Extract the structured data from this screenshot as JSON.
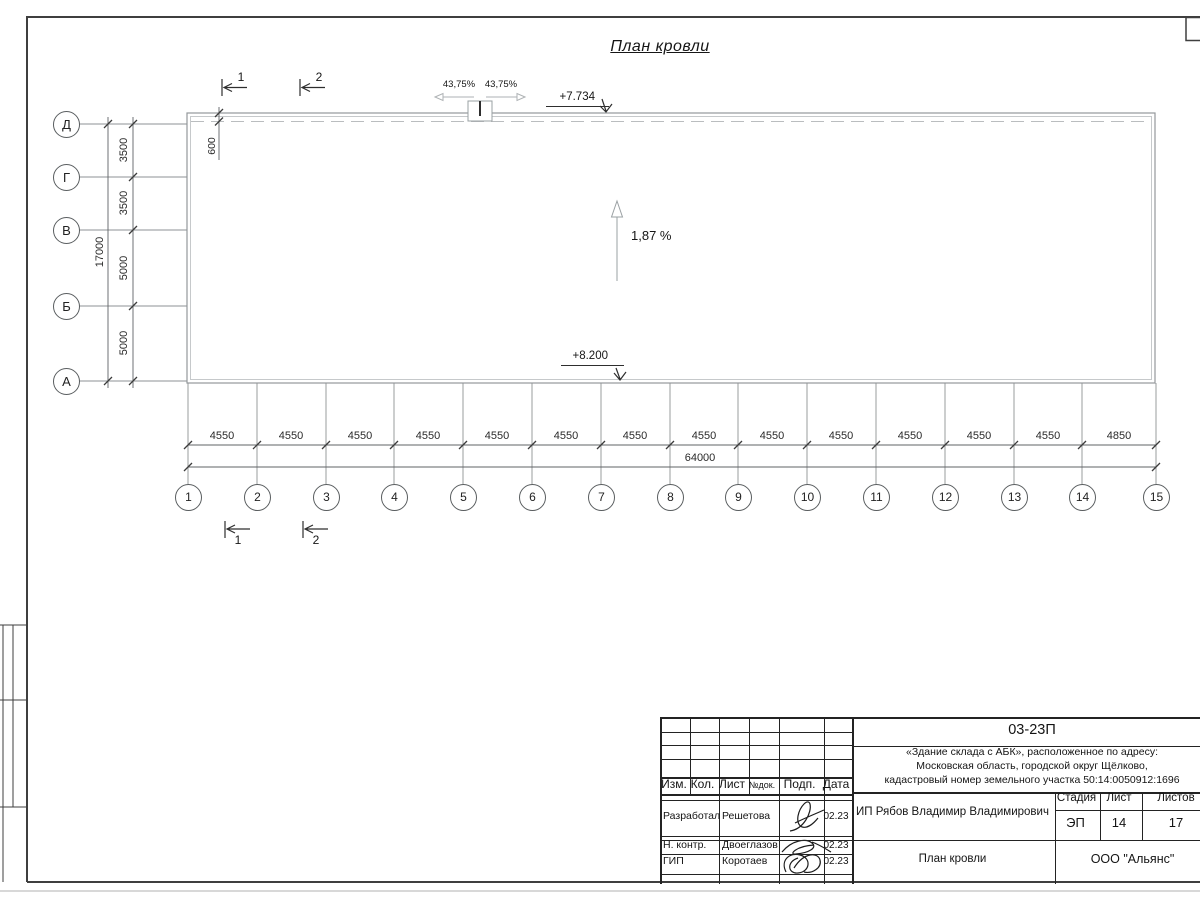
{
  "drawing": {
    "title": "План кровли",
    "slope_label": "1,87 %",
    "elevation_top": "+7.734",
    "elevation_bottom": "+8.200",
    "funnel_slope_left": "43,75%",
    "funnel_slope_right": "43,75%",
    "parapet_offset_dim": "600"
  },
  "axes_vertical": {
    "labels": [
      "Д",
      "Г",
      "В",
      "Б",
      "А"
    ],
    "dims": [
      "3500",
      "3500",
      "5000",
      "5000"
    ],
    "total": "17000"
  },
  "axes_horizontal": {
    "labels": [
      "1",
      "2",
      "3",
      "4",
      "5",
      "6",
      "7",
      "8",
      "9",
      "10",
      "11",
      "12",
      "13",
      "14",
      "15"
    ],
    "dims": [
      "4550",
      "4550",
      "4550",
      "4550",
      "4550",
      "4550",
      "4550",
      "4550",
      "4550",
      "4550",
      "4550",
      "4550",
      "4550",
      "4850"
    ],
    "total": "64000"
  },
  "section_marks": {
    "top": [
      "1",
      "2"
    ],
    "bottom": [
      "1",
      "2"
    ]
  },
  "titleblock": {
    "doc_number": "03-23П",
    "project_address_lines": [
      "«Здание склада с АБК», расположенное по адресу:",
      "Московская область, городской округ Щёлково,",
      "кадастровый номер земельного участка 50:14:0050912:1696"
    ],
    "columns": [
      "Изм.",
      "Кол.",
      "Лист",
      "№док.",
      "Подп.",
      "Дата"
    ],
    "signature_rows": [
      {
        "role": "Разработал",
        "name": "Решетова",
        "date": "02.23"
      },
      {
        "role": "Н. контр.",
        "name": "Двоеглазов",
        "date": "02.23"
      },
      {
        "role": "ГИП",
        "name": "Коротаев",
        "date": "02.23"
      }
    ],
    "client": "ИП Рябов Владимир Владимирович",
    "stage_label": "Стадия",
    "sheet_label": "Лист",
    "sheets_label": "Листов",
    "stage_value": "ЭП",
    "sheet_value": "14",
    "sheets_value": "17",
    "drawing_name": "План кровли",
    "company": "ООО \"Альянс\""
  }
}
